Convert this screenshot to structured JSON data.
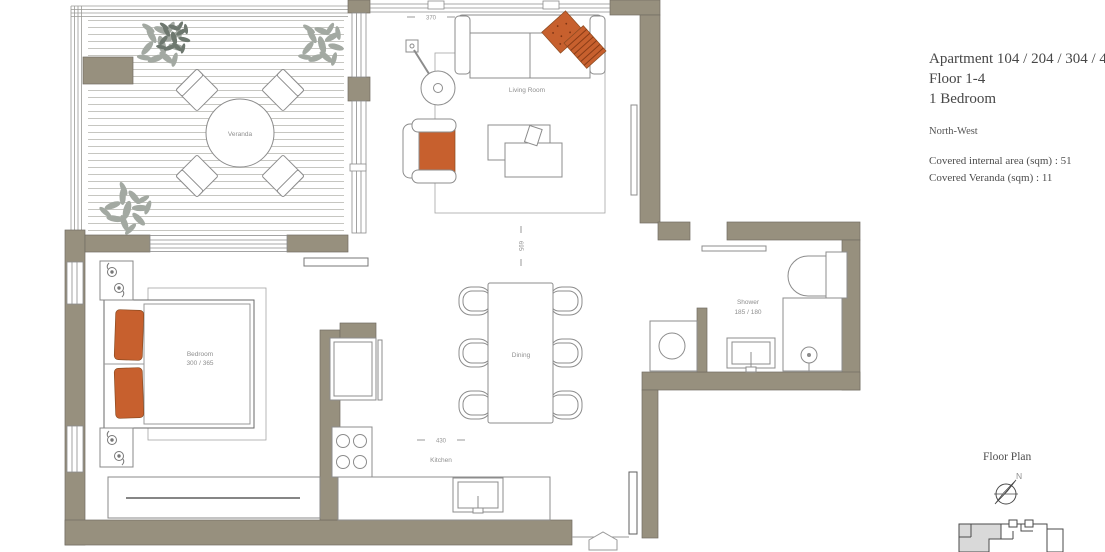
{
  "title_block": {
    "apartment": "Apartment 104 / 204 / 304 / 404",
    "floor": "Floor 1-4",
    "bedrooms": "1 Bedroom",
    "orientation": "North-West",
    "area_internal": "Covered internal area (sqm) : 51",
    "area_veranda": "Covered Veranda (sqm) : 11"
  },
  "floor_plan": {
    "labels": {
      "veranda": "Veranda",
      "living_room": "Living Room",
      "bedroom": "Bedroom",
      "bedroom_dims": "300 / 365",
      "dining": "Dining",
      "kitchen": "Kitchen",
      "shower": "Shower",
      "shower_dims": "185 / 180"
    },
    "dimensions": {
      "top_width": "370",
      "vertical_depth": "695",
      "kitchen_width": "430"
    }
  },
  "legend": {
    "floor_plan_label": "Floor Plan",
    "compass_north": "N"
  },
  "colors": {
    "wall": "#97907e",
    "accent_orange": "#c7602e",
    "line_gray": "#8c8c8c"
  }
}
